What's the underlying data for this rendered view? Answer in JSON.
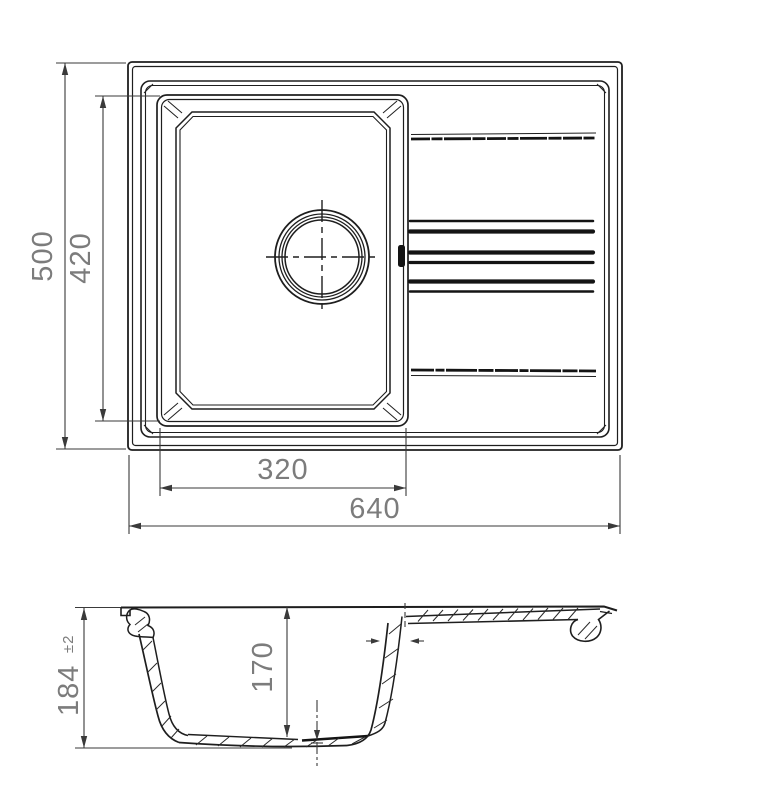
{
  "drawing": {
    "top_view": {
      "overall_width_mm": "640",
      "overall_depth_mm": "500",
      "bowl_width_mm": "320",
      "bowl_depth_mm": "420"
    },
    "side_view": {
      "overall_height_mm": "184",
      "height_tolerance": "±2",
      "bowl_inner_depth_mm": "170"
    },
    "colors": {
      "line": "#1e1e1e",
      "dimension_line": "#3a3a3a",
      "dimension_text": "#7c7c7c",
      "background": "#ffffff"
    }
  }
}
